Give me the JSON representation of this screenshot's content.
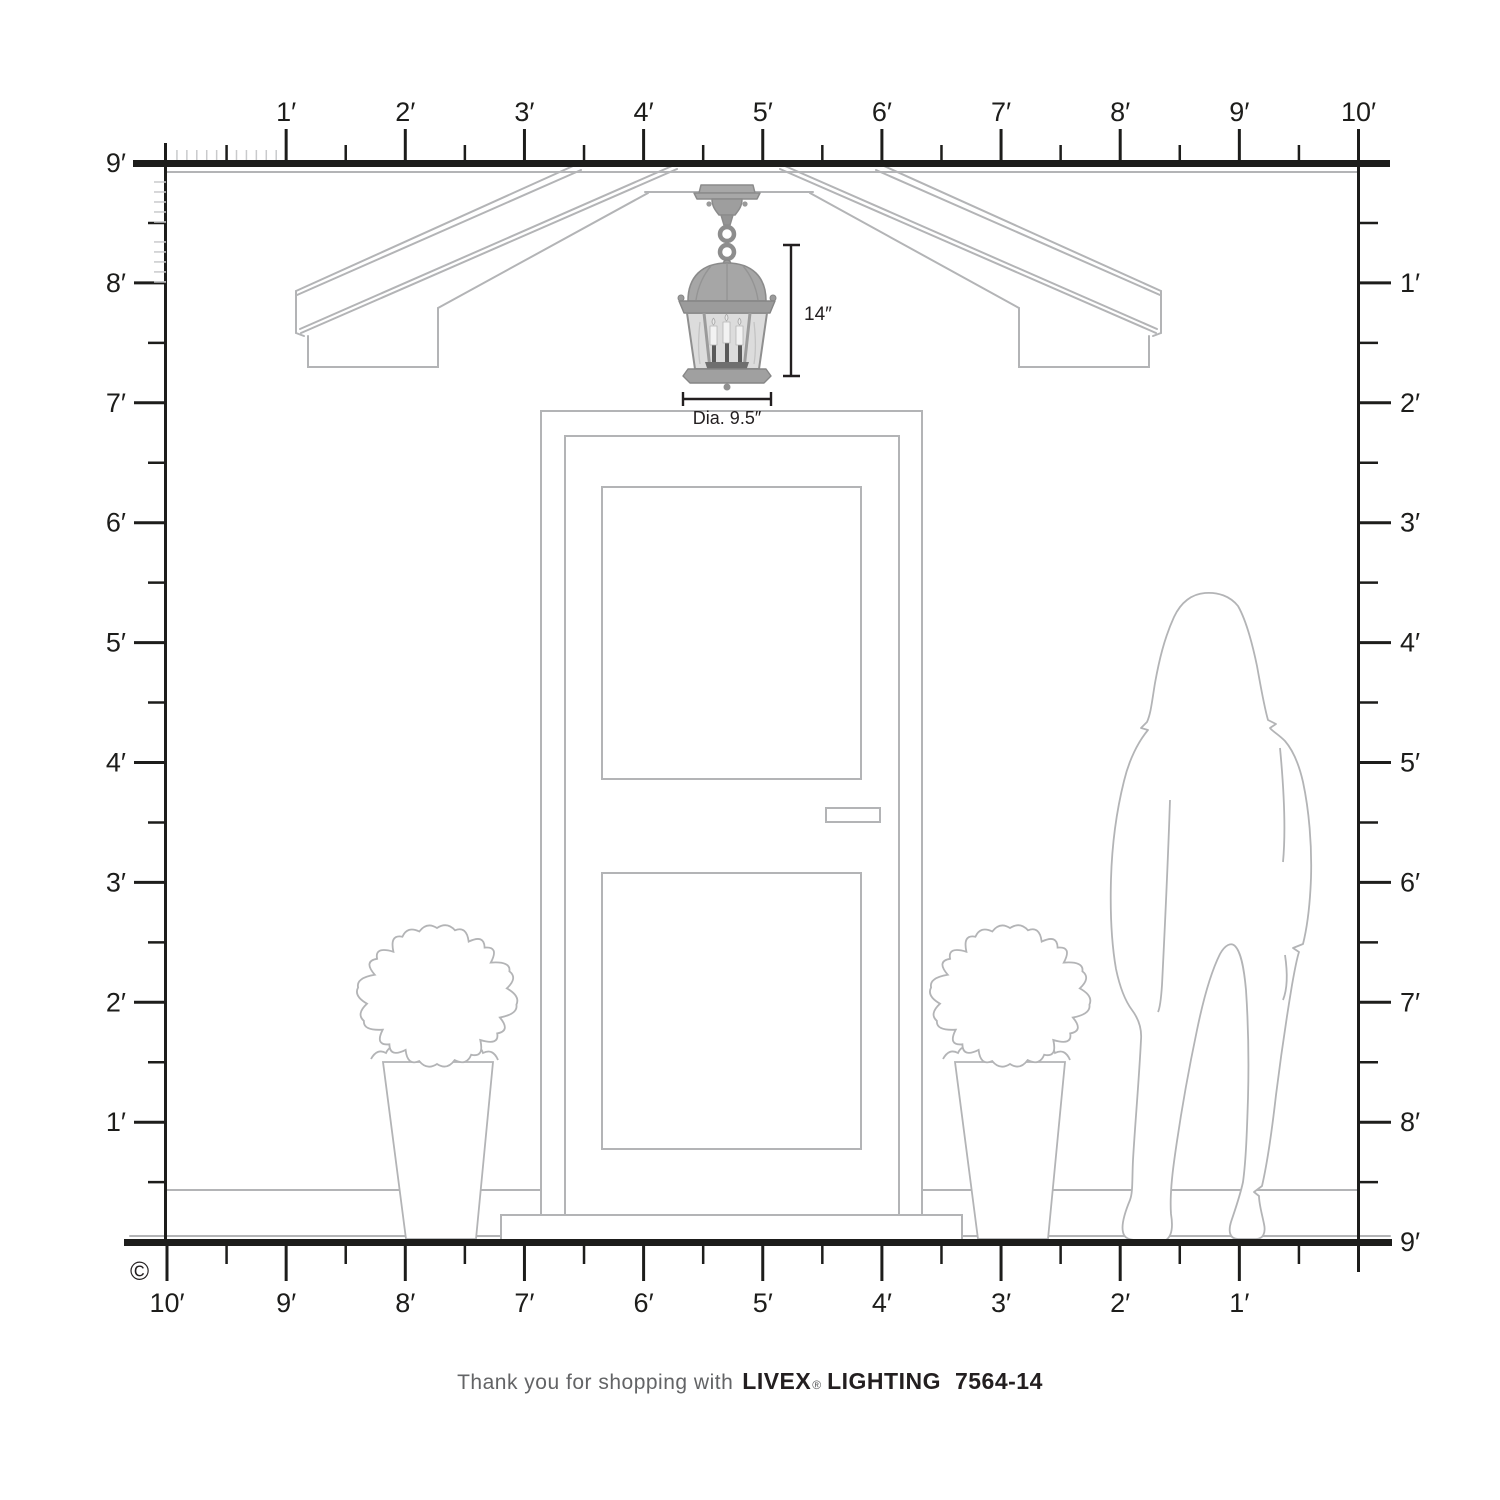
{
  "colors": {
    "ink": "#1d1d1b",
    "drawing_line": "#b3b4b6",
    "inch_tick": "#c9cacc",
    "lantern_metal": "#a5a5a5",
    "lantern_metal_dark": "#8b8b8b",
    "lantern_glass": "#dcdcdc",
    "caption_gray": "#636466"
  },
  "rulers": {
    "top_labels": [
      "1′",
      "2′",
      "3′",
      "4′",
      "5′",
      "6′",
      "7′",
      "8′",
      "9′",
      "10′"
    ],
    "left_labels": [
      "9′",
      "8′",
      "7′",
      "6′",
      "5′",
      "4′",
      "3′",
      "2′",
      "1′"
    ],
    "right_labels": [
      "1′",
      "2′",
      "3′",
      "4′",
      "5′",
      "6′",
      "7′",
      "8′",
      "9′"
    ],
    "bottom_labels": [
      "10′",
      "9′",
      "8′",
      "7′",
      "6′",
      "5′",
      "4′",
      "3′",
      "2′",
      "1′"
    ]
  },
  "annotations": {
    "height_label": "14″",
    "diameter_label": "Dia. 9.5″"
  },
  "caption": {
    "prefix": "Thank you for shopping with",
    "brand": "LIVEX",
    "registered": "®",
    "brand2": "LIGHTING",
    "model": "7564-14"
  },
  "copyright_symbol": "©"
}
